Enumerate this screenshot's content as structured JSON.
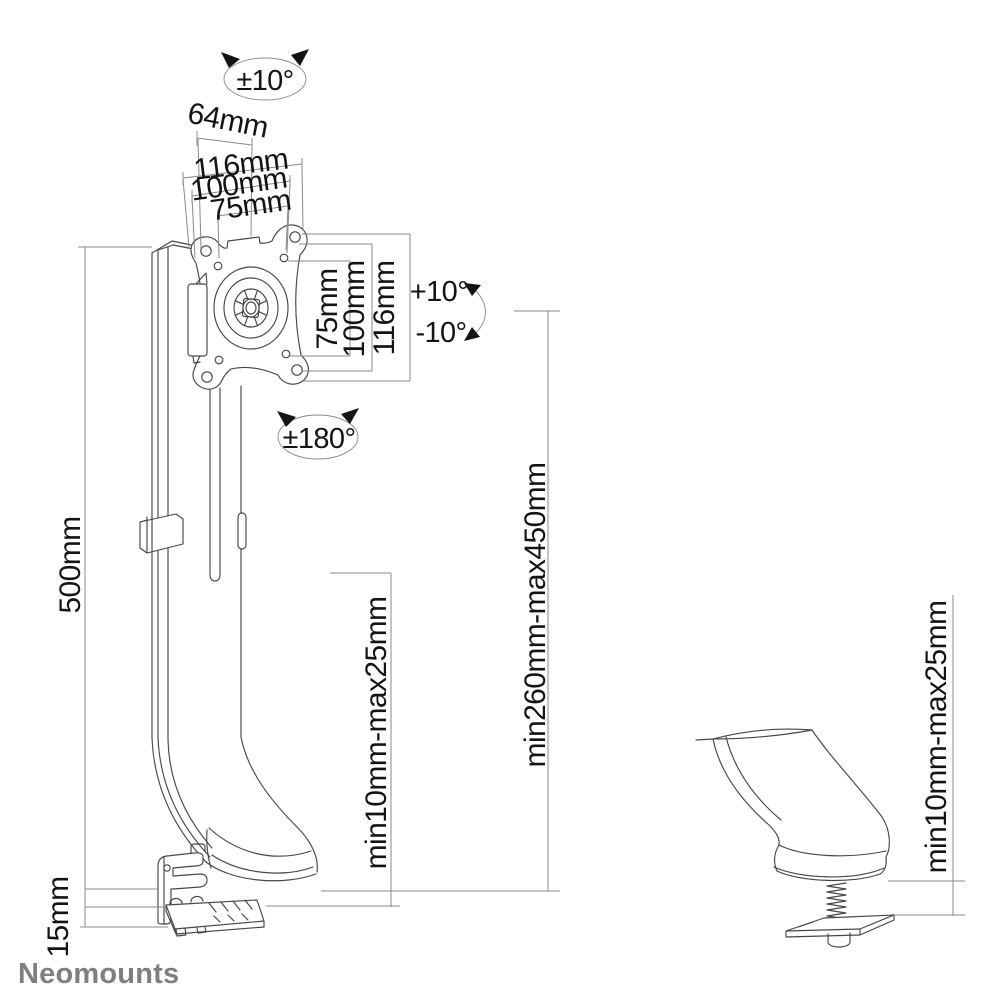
{
  "colors": {
    "background": "#ffffff",
    "line": "#474747",
    "dim": "#8a8a8a",
    "text": "#141414",
    "logo": "#7f7f7f"
  },
  "labels": {
    "rotation_mount_top": "±10°",
    "offset_depth": "64mm",
    "vesa_width_outer": "116mm",
    "vesa_width_100": "100mm",
    "vesa_width_75": "75mm",
    "vesa_height_75": "75mm",
    "vesa_height_100": "100mm",
    "vesa_height_outer": "116mm",
    "tilt_up": "+10°",
    "tilt_down": "-10°",
    "rotation_vesa": "±180°",
    "pole_height": "500mm",
    "desk_thickness_clamp": "min10mm-max25mm",
    "height_range": "min260mm-max450mm",
    "clamp_plate_depth": "15mm",
    "desk_thickness_grommet": "min10mm-max25mm"
  },
  "logo": "Neomounts"
}
